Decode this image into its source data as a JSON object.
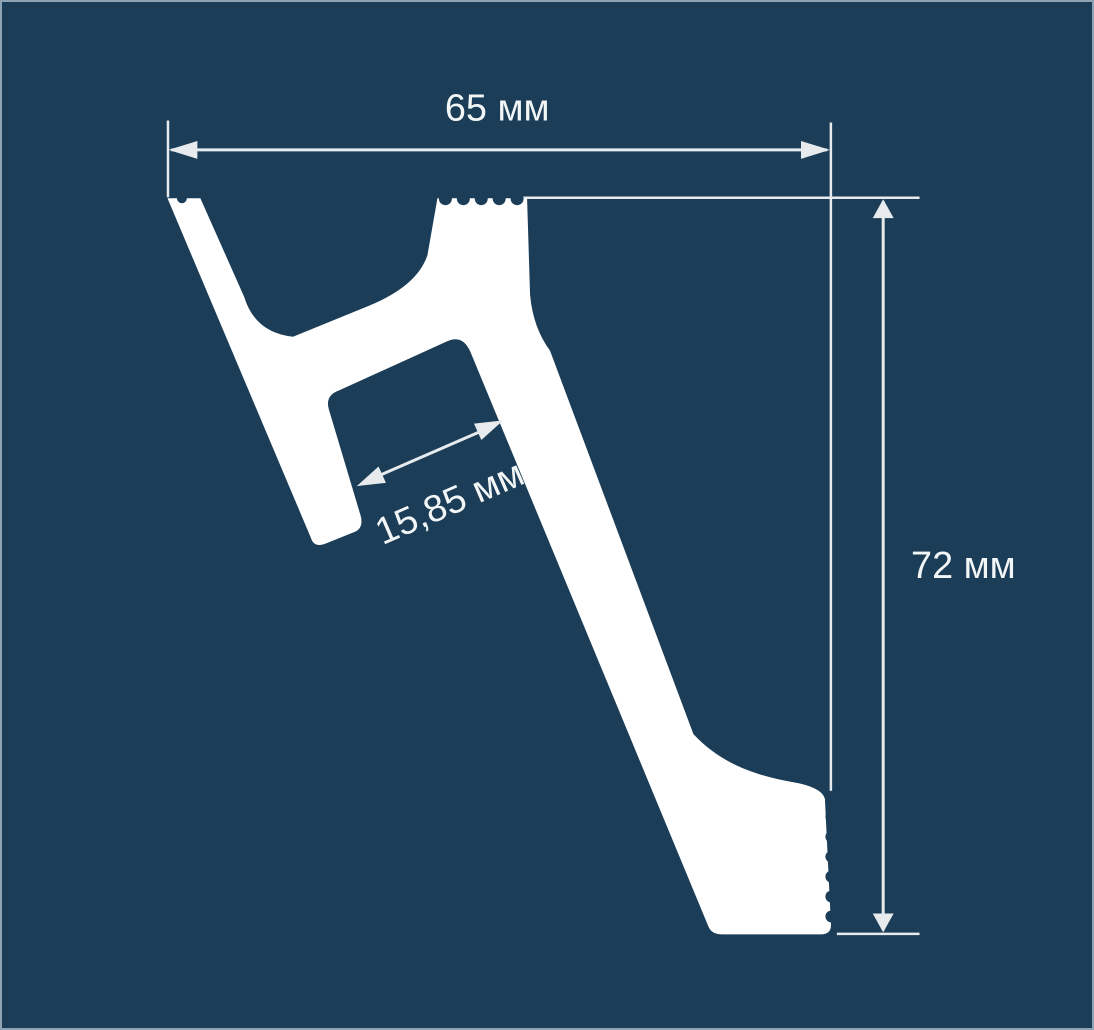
{
  "dimensions": {
    "width": {
      "label": "65 мм",
      "value": "65",
      "unit": "мм"
    },
    "height": {
      "label": "72 мм",
      "value": "72",
      "unit": "мм"
    },
    "slot": {
      "label": "15,85 мм",
      "value": "15,85",
      "unit": "мм"
    }
  },
  "colors": {
    "background": "#1b3d57",
    "profile": "#ffffff",
    "dimension_lines": "#e7ebee",
    "text": "#f3f6f7",
    "border": "#8ea3b3"
  }
}
